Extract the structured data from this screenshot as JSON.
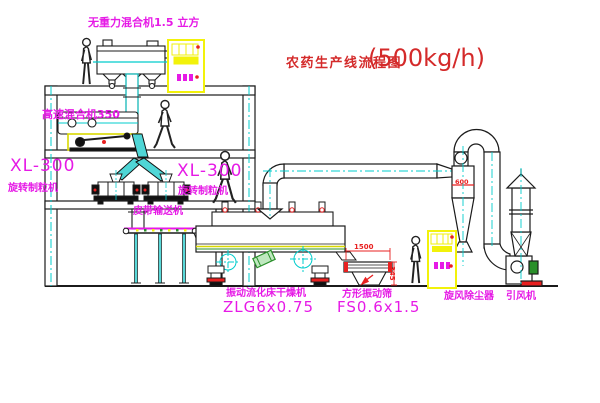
{
  "title": {
    "name": "农药生产线流程图",
    "capacity": "(500kg/h)"
  },
  "equipment": {
    "gravity_mixer_label": "无重力混合机1.5 立方",
    "high_speed_mixer_label": "高速混合机350",
    "granulator_left": {
      "model": "XL-300",
      "name": "旋转制粒机"
    },
    "granulator_mid": {
      "model": "XL-300",
      "name": "旋转制粒机"
    },
    "belt_conveyor_label": "皮带输送机",
    "dryer": {
      "name": "振动流化床干燥机",
      "model": "ZLG6x0.75"
    },
    "sieve": {
      "name": "方形振动筛",
      "model": "FS0.6x1.5"
    },
    "cyclone_label": "旋风除尘器",
    "fan_label": "引风机"
  },
  "dimensions": {
    "sieve_length": "1500",
    "sieve_height": "345",
    "cyclone_body": "600"
  },
  "colors": {
    "label_magenta": "#e61ae6",
    "title_red": "#d42a2a",
    "annotation_red": "#e82020",
    "centerline_cyan": "#00cccc",
    "highlight_yellow": "#f2f20a",
    "machine_green": "#2a8f2a",
    "line_black": "#1b1b1b",
    "background": "#ffffff"
  }
}
